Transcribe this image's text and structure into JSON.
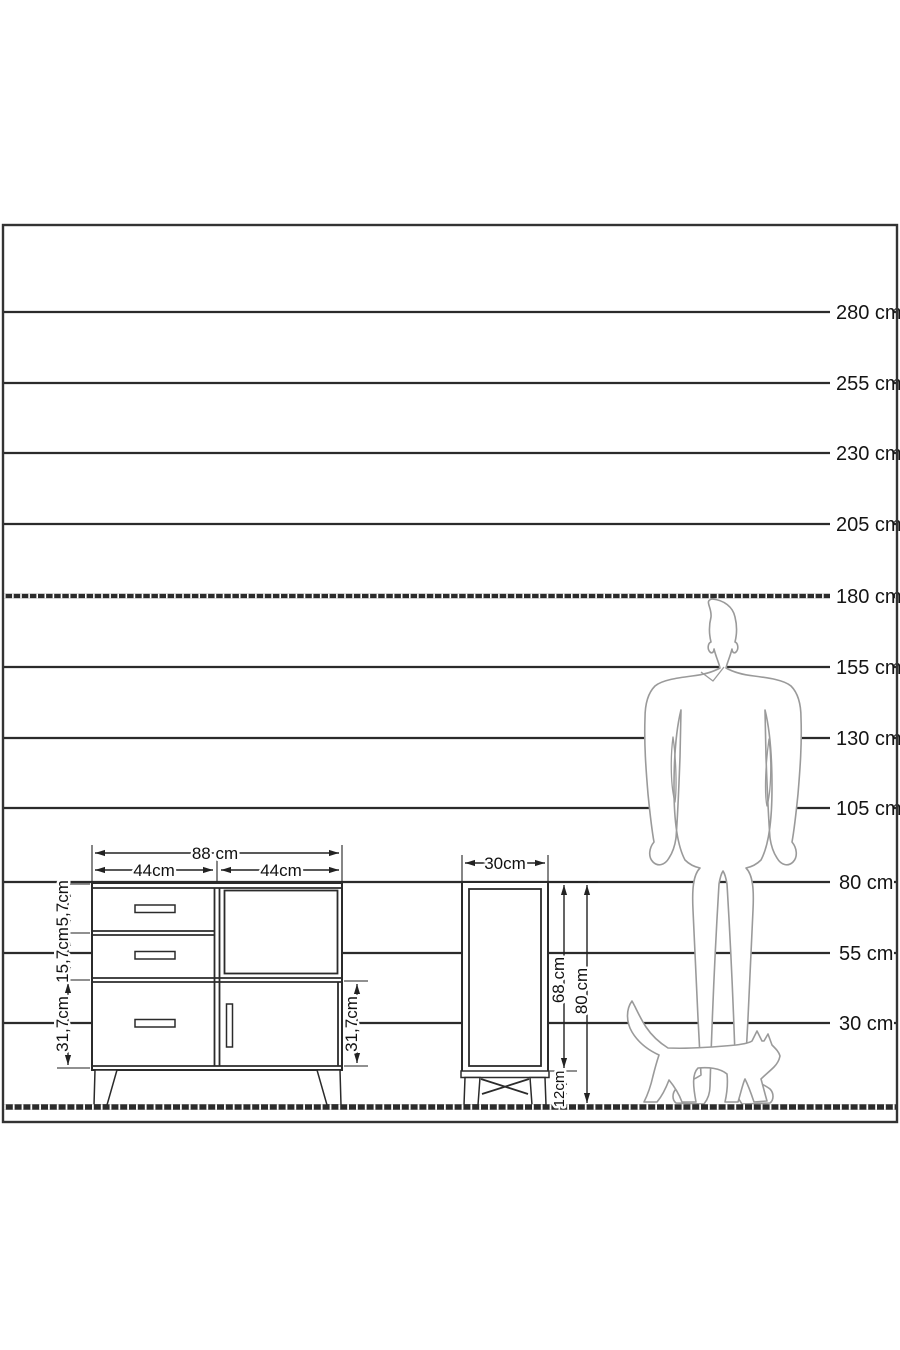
{
  "diagram": {
    "type": "furniture-dimension-diagram",
    "scale_labels": [
      "280 cm",
      "255 cm",
      "230 cm",
      "205 cm",
      "180 cm",
      "155 cm",
      "130 cm",
      "105 cm",
      "80 cm",
      "55 cm",
      "30 cm"
    ],
    "sideboard": {
      "total_width": "88 cm",
      "left_section_width": "44cm",
      "right_section_width": "44cm",
      "top_drawer_height": "15,7cm",
      "middle_drawer_height": "15,7cm",
      "bottom_drawer_height": "31,7cm",
      "door_height": "31,7cm"
    },
    "side_cabinet": {
      "width": "30cm",
      "body_height": "68 cm",
      "total_height": "80 cm",
      "leg_height": "12cm"
    },
    "colors": {
      "scale_line": "#2b2b2b",
      "dimension_line": "#222222",
      "silhouette_outline": "#9a9a9a",
      "label_text": "#141414",
      "background": "#ffffff"
    }
  }
}
